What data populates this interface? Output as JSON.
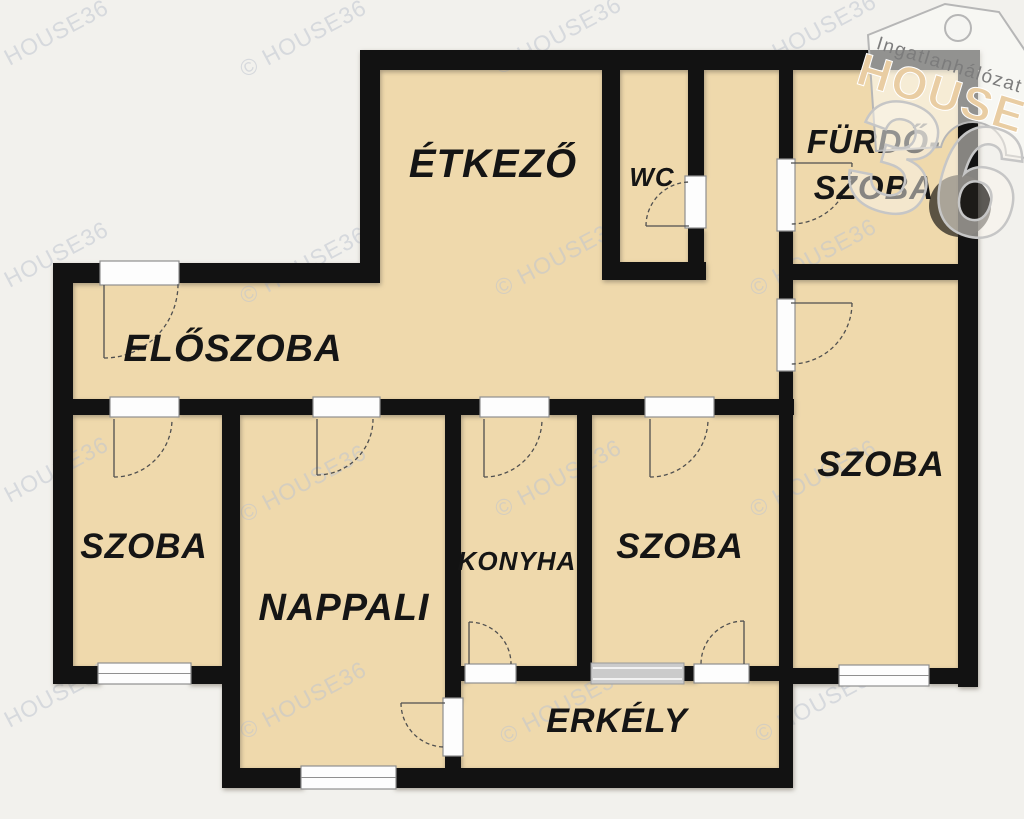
{
  "colors": {
    "room": "#EFD9AC",
    "wall": "#121212",
    "background": "#F2F1ED",
    "frame": "#FDFDFD",
    "watermark": "#C0C4D0",
    "logo_tan": "#E9CDA3"
  },
  "watermark": {
    "text": "© HOUSE36"
  },
  "logo": {
    "brand_top": "Ingatlanhálózat",
    "brand_main": "HOUSE",
    "brand_number": "36"
  },
  "rooms": {
    "etkezo": {
      "label": "ÉTKEZŐ"
    },
    "wc": {
      "label": "WC"
    },
    "furdoszoba": {
      "label_line1": "FÜRDŐ-",
      "label_line2": "SZOBA"
    },
    "eloszoba": {
      "label": "ELŐSZOBA"
    },
    "szoba_left": {
      "label": "SZOBA"
    },
    "nappali": {
      "label": "NAPPALI"
    },
    "konyha": {
      "label": "KONYHA"
    },
    "szoba_middle": {
      "label": "SZOBA"
    },
    "szoba_right": {
      "label": "SZOBA"
    },
    "erkely": {
      "label": "ERKÉLY"
    }
  }
}
